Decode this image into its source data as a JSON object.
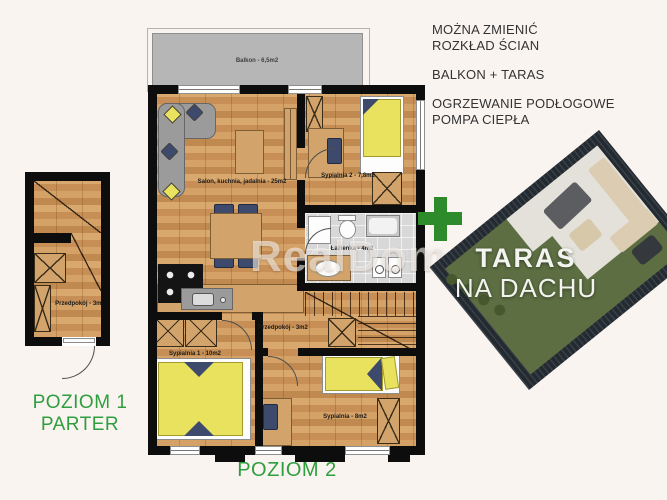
{
  "info": {
    "l1": "MOŻNA ZMIENIĆ",
    "l2": "ROZKŁAD ŚCIAN",
    "l3": "BALKON + TARAS",
    "l4": "OGRZEWANIE PODŁOGOWE",
    "l5": "POMPA CIEPŁA"
  },
  "levels": {
    "p1a": "POZIOM 1",
    "p1b": "PARTER",
    "p2": "POZIOM 2"
  },
  "rooms": {
    "balkon": "Balkon - 6,5m2",
    "salon": "Salon, kuchnia, jadalnia - 25m2",
    "sypialnia2": "Sypialnia 2 - 7,8m2",
    "lazienka": "Łazienka - 4m2",
    "przedpokoj": "Przedpokój - 3m2",
    "sypialnia1": "Sypialnia 1 - 10m2",
    "sypialnia": "Sypialnia - 8m2",
    "przedpokoj_parter": "Przedpokój - 3m2"
  },
  "terrace": {
    "plus": "+",
    "title": "TARAS",
    "subtitle": "NA DACHU"
  },
  "watermark": "RealDom",
  "colors": {
    "accent_green": "#2f9e3e",
    "plus_green": "#2e8b2c",
    "wall_black": "#0d0d0d",
    "wood_tan": "#cf9a62",
    "furniture_yellow": "#e9e25e",
    "pillow_navy": "#3d4a6b",
    "balcony_gray": "#b6b6b6",
    "terrace_lawn": "#5c6e42",
    "terrace_fence": "#232a31"
  }
}
